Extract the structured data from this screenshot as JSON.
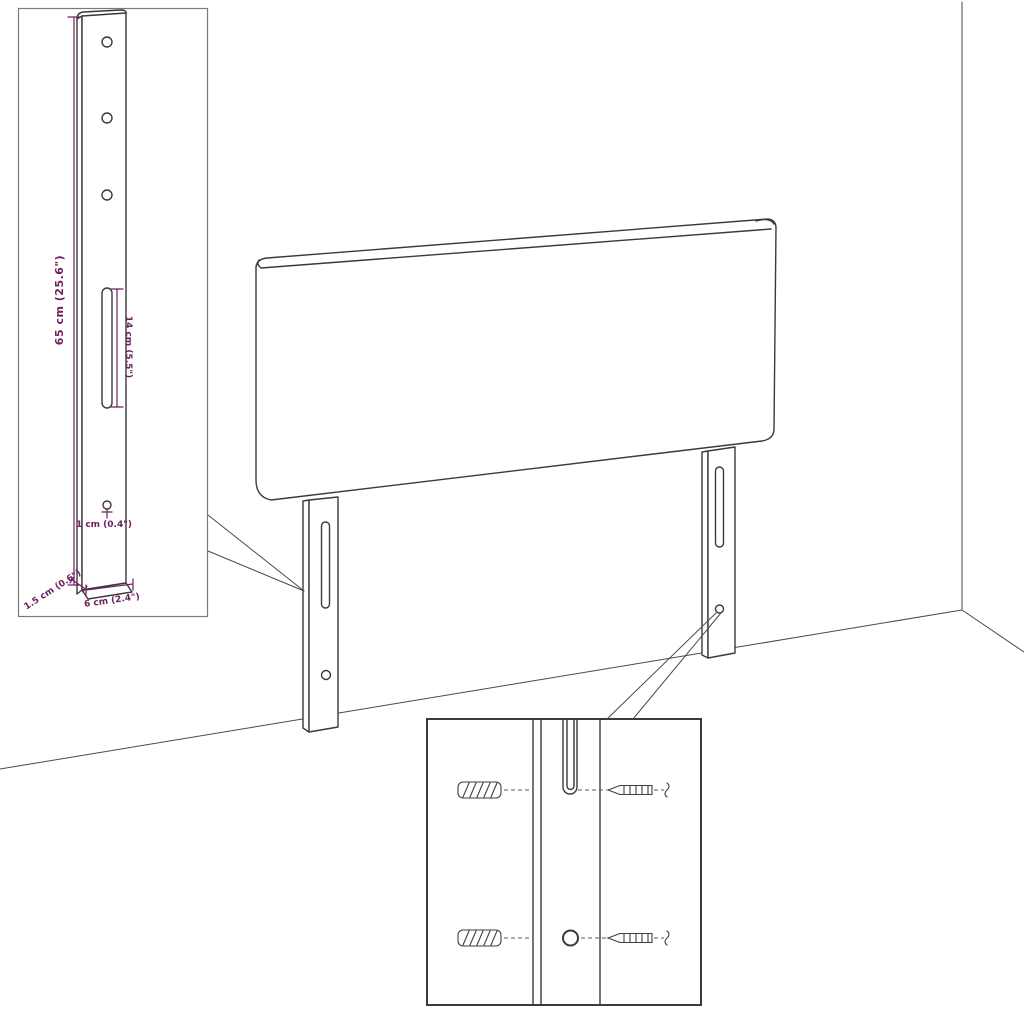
{
  "colors": {
    "accent": "#6e2060",
    "line": "#3a3a3a",
    "background": "#ffffff"
  },
  "leg_detail_inset": {
    "dimensions": {
      "height": "65 cm (25.6\")",
      "slot_length": "14 cm (5.5\")",
      "hole_diameter": "1 cm (0.4\")",
      "thickness": "1.5 cm (0.6\")",
      "width": "6 cm (2.4\")"
    }
  }
}
